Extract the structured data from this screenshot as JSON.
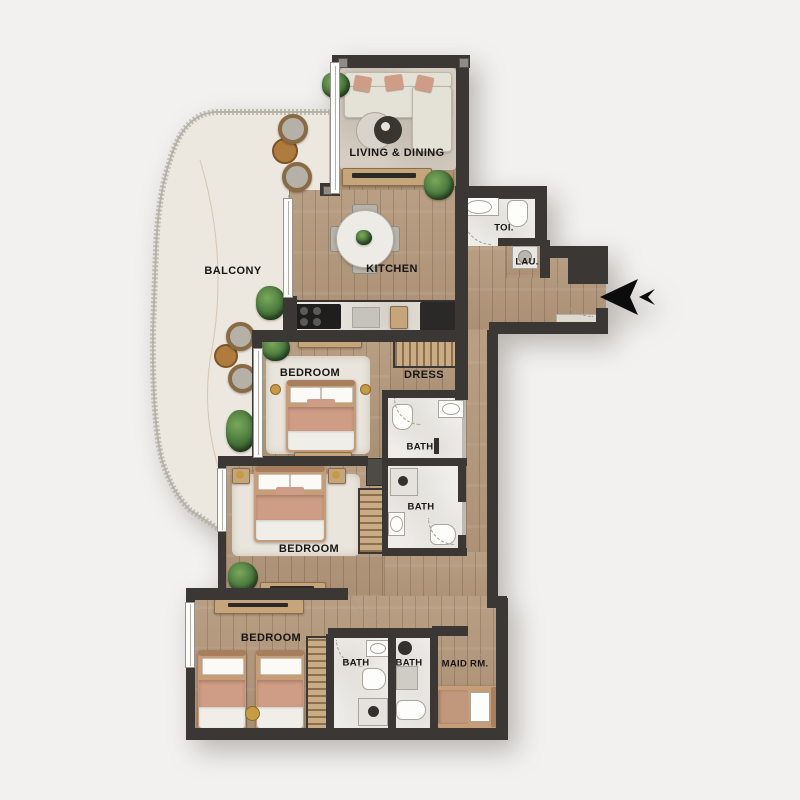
{
  "plan_type": "apartment-floor-plan",
  "rooms": {
    "living_dining": {
      "label": "LIVING & DINING"
    },
    "kitchen": {
      "label": "KITCHEN"
    },
    "balcony": {
      "label": "BALCONY"
    },
    "toilet": {
      "label": "TOI."
    },
    "laundry": {
      "label": "LAU."
    },
    "dress": {
      "label": "DRESS"
    },
    "bedroom_1": {
      "label": "BEDROOM"
    },
    "bath_1": {
      "label": "BATH"
    },
    "bedroom_2": {
      "label": "BEDROOM"
    },
    "bath_2": {
      "label": "BATH"
    },
    "bedroom_3": {
      "label": "BEDROOM"
    },
    "bath_3": {
      "label": "BATH"
    },
    "bath_4": {
      "label": "BATH"
    },
    "maid_room": {
      "label": "MAID RM."
    }
  },
  "entry": {
    "icon": "entrance-arrow"
  },
  "colors": {
    "bg": "#f2f1ef",
    "wall": "#3a3734",
    "wood": "#b3977a",
    "balcony_floor": "#ece8e0",
    "bath": "#efeeea",
    "rug": "#d6cec3",
    "rug_light": "#eae5dc",
    "sofa": "#e4e2d7",
    "accent": "#cf9d85",
    "plant": "#47763c",
    "wood_furniture": "#c6a57b"
  }
}
